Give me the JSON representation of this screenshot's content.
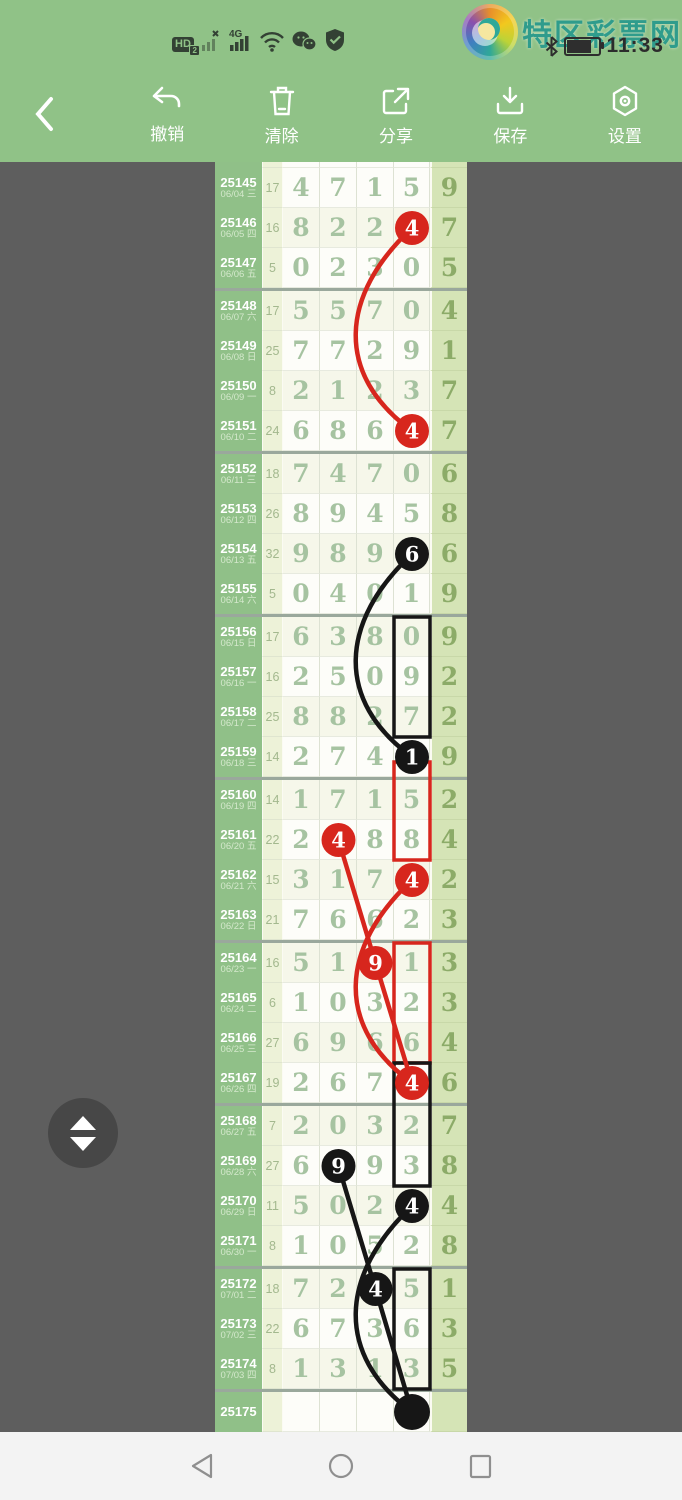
{
  "status_bar": {
    "time": "11:33",
    "hd_label": "HD",
    "hd_badge": "2",
    "network_label": "4G",
    "left_icons": [
      "hd-icon",
      "no-sim-signal-icon",
      "4g-signal-icon",
      "wifi-icon",
      "wechat-icon",
      "security-shield-icon"
    ],
    "right_icons": [
      "bluetooth-icon",
      "battery-icon"
    ]
  },
  "brand": {
    "logo_text": "特区彩票网"
  },
  "toolbar": {
    "items": [
      {
        "label": "撤销",
        "icon": "undo-icon"
      },
      {
        "label": "清除",
        "icon": "trash-icon"
      },
      {
        "label": "分享",
        "icon": "share-icon"
      },
      {
        "label": "保存",
        "icon": "save-icon"
      },
      {
        "label": "设置",
        "icon": "settings-icon"
      }
    ]
  },
  "colors": {
    "header_green": "#90c287",
    "period_col_green": "#90c088",
    "tail_col_green": "#d5e4b6",
    "mark_red": "#d7261d",
    "mark_black": "#161616"
  },
  "chart": {
    "type": "table",
    "group_separators_after": [
      "25147",
      "25151",
      "25155",
      "25159",
      "25163",
      "25167",
      "25171",
      "25174"
    ],
    "rows": [
      {
        "period": "25145",
        "date": "06/04 三",
        "count": "17",
        "digits": [
          "4",
          "7",
          "1",
          "5"
        ],
        "tail": "9"
      },
      {
        "period": "25146",
        "date": "06/05 四",
        "count": "16",
        "digits": [
          "8",
          "2",
          "2",
          "4"
        ],
        "tail": "7"
      },
      {
        "period": "25147",
        "date": "06/06 五",
        "count": "5",
        "digits": [
          "0",
          "2",
          "3",
          "0"
        ],
        "tail": "5"
      },
      {
        "period": "25148",
        "date": "06/07 六",
        "count": "17",
        "digits": [
          "5",
          "5",
          "7",
          "0"
        ],
        "tail": "4"
      },
      {
        "period": "25149",
        "date": "06/08 日",
        "count": "25",
        "digits": [
          "7",
          "7",
          "2",
          "9"
        ],
        "tail": "1"
      },
      {
        "period": "25150",
        "date": "06/09 一",
        "count": "8",
        "digits": [
          "2",
          "1",
          "2",
          "3"
        ],
        "tail": "7"
      },
      {
        "period": "25151",
        "date": "06/10 二",
        "count": "24",
        "digits": [
          "6",
          "8",
          "6",
          "4"
        ],
        "tail": "7"
      },
      {
        "period": "25152",
        "date": "06/11 三",
        "count": "18",
        "digits": [
          "7",
          "4",
          "7",
          "0"
        ],
        "tail": "6"
      },
      {
        "period": "25153",
        "date": "06/12 四",
        "count": "26",
        "digits": [
          "8",
          "9",
          "4",
          "5"
        ],
        "tail": "8"
      },
      {
        "period": "25154",
        "date": "06/13 五",
        "count": "32",
        "digits": [
          "9",
          "8",
          "9",
          "6"
        ],
        "tail": "6"
      },
      {
        "period": "25155",
        "date": "06/14 六",
        "count": "5",
        "digits": [
          "0",
          "4",
          "0",
          "1"
        ],
        "tail": "9"
      },
      {
        "period": "25156",
        "date": "06/15 日",
        "count": "17",
        "digits": [
          "6",
          "3",
          "8",
          "0"
        ],
        "tail": "9"
      },
      {
        "period": "25157",
        "date": "06/16 一",
        "count": "16",
        "digits": [
          "2",
          "5",
          "0",
          "9"
        ],
        "tail": "2"
      },
      {
        "period": "25158",
        "date": "06/17 二",
        "count": "25",
        "digits": [
          "8",
          "8",
          "2",
          "7"
        ],
        "tail": "2"
      },
      {
        "period": "25159",
        "date": "06/18 三",
        "count": "14",
        "digits": [
          "2",
          "7",
          "4",
          "1"
        ],
        "tail": "9"
      },
      {
        "period": "25160",
        "date": "06/19 四",
        "count": "14",
        "digits": [
          "1",
          "7",
          "1",
          "5"
        ],
        "tail": "2"
      },
      {
        "period": "25161",
        "date": "06/20 五",
        "count": "22",
        "digits": [
          "2",
          "4",
          "8",
          "8"
        ],
        "tail": "4"
      },
      {
        "period": "25162",
        "date": "06/21 六",
        "count": "15",
        "digits": [
          "3",
          "1",
          "7",
          "4"
        ],
        "tail": "2"
      },
      {
        "period": "25163",
        "date": "06/22 日",
        "count": "21",
        "digits": [
          "7",
          "6",
          "6",
          "2"
        ],
        "tail": "3"
      },
      {
        "period": "25164",
        "date": "06/23 一",
        "count": "16",
        "digits": [
          "5",
          "1",
          "9",
          "1"
        ],
        "tail": "3"
      },
      {
        "period": "25165",
        "date": "06/24 二",
        "count": "6",
        "digits": [
          "1",
          "0",
          "3",
          "2"
        ],
        "tail": "3"
      },
      {
        "period": "25166",
        "date": "06/25 三",
        "count": "27",
        "digits": [
          "6",
          "9",
          "6",
          "6"
        ],
        "tail": "4"
      },
      {
        "period": "25167",
        "date": "06/26 四",
        "count": "19",
        "digits": [
          "2",
          "6",
          "7",
          "4"
        ],
        "tail": "6"
      },
      {
        "period": "25168",
        "date": "06/27 五",
        "count": "7",
        "digits": [
          "2",
          "0",
          "3",
          "2"
        ],
        "tail": "7"
      },
      {
        "period": "25169",
        "date": "06/28 六",
        "count": "27",
        "digits": [
          "6",
          "9",
          "9",
          "3"
        ],
        "tail": "8"
      },
      {
        "period": "25170",
        "date": "06/29 日",
        "count": "11",
        "digits": [
          "5",
          "0",
          "2",
          "4"
        ],
        "tail": "4"
      },
      {
        "period": "25171",
        "date": "06/30 一",
        "count": "8",
        "digits": [
          "1",
          "0",
          "5",
          "2"
        ],
        "tail": "8"
      },
      {
        "period": "25172",
        "date": "07/01 二",
        "count": "18",
        "digits": [
          "7",
          "2",
          "4",
          "5"
        ],
        "tail": "1"
      },
      {
        "period": "25173",
        "date": "07/02 三",
        "count": "22",
        "digits": [
          "6",
          "7",
          "3",
          "6"
        ],
        "tail": "3"
      },
      {
        "period": "25174",
        "date": "07/03 四",
        "count": "8",
        "digits": [
          "1",
          "3",
          "1",
          "3"
        ],
        "tail": "5"
      },
      {
        "period": "25175",
        "date": "",
        "count": "",
        "digits": [
          "",
          "",
          "",
          ""
        ],
        "tail": ""
      }
    ],
    "marks": {
      "circles": [
        {
          "row": "25146",
          "col": 4,
          "value": "4",
          "color": "red"
        },
        {
          "row": "25151",
          "col": 4,
          "value": "4",
          "color": "red"
        },
        {
          "row": "25154",
          "col": 4,
          "value": "6",
          "color": "black"
        },
        {
          "row": "25159",
          "col": 4,
          "value": "1",
          "color": "black"
        },
        {
          "row": "25161",
          "col": 2,
          "value": "4",
          "color": "red"
        },
        {
          "row": "25162",
          "col": 4,
          "value": "4",
          "color": "red"
        },
        {
          "row": "25164",
          "col": 3,
          "value": "9",
          "color": "red"
        },
        {
          "row": "25167",
          "col": 4,
          "value": "4",
          "color": "red"
        },
        {
          "row": "25169",
          "col": 2,
          "value": "9",
          "color": "black"
        },
        {
          "row": "25170",
          "col": 4,
          "value": "4",
          "color": "black"
        },
        {
          "row": "25172",
          "col": 3,
          "value": "4",
          "color": "black"
        },
        {
          "row": "25175",
          "col": 4,
          "value": "",
          "color": "black",
          "filled_dot": true
        }
      ],
      "boxes": [
        {
          "from": "25156",
          "to": "25158",
          "col": 4,
          "color": "black"
        },
        {
          "from": "25160",
          "to": "25161",
          "col": 4,
          "color": "red",
          "extend_top": true
        },
        {
          "from": "25164",
          "to": "25166",
          "col": 4,
          "color": "red"
        },
        {
          "from": "25167",
          "to": "25169",
          "col": 4,
          "color": "black"
        },
        {
          "from": "25172",
          "to": "25174",
          "col": 4,
          "color": "black"
        }
      ],
      "lines": [
        {
          "from": "25146",
          "fcol": 4,
          "to": "25151",
          "tcol": 4,
          "color": "red",
          "curve": "left"
        },
        {
          "from": "25154",
          "fcol": 4,
          "to": "25159",
          "tcol": 4,
          "color": "black",
          "curve": "left"
        },
        {
          "from": "25161",
          "fcol": 2,
          "to": "25164",
          "tcol": 3,
          "color": "red",
          "curve": "none"
        },
        {
          "from": "25164",
          "fcol": 3,
          "to": "25167",
          "tcol": 4,
          "color": "red",
          "curve": "none"
        },
        {
          "from": "25162",
          "fcol": 4,
          "to": "25167",
          "tcol": 4,
          "color": "red",
          "curve": "left"
        },
        {
          "from": "25169",
          "fcol": 2,
          "to": "25172",
          "tcol": 3,
          "color": "black",
          "curve": "none"
        },
        {
          "from": "25172",
          "fcol": 3,
          "to": "25175",
          "tcol": 4,
          "color": "black",
          "curve": "none"
        },
        {
          "from": "25170",
          "fcol": 4,
          "to": "25175",
          "tcol": 4,
          "color": "black",
          "curve": "left"
        }
      ]
    }
  },
  "nav_bar": {
    "icons": [
      "back-triangle-icon",
      "home-circle-icon",
      "recents-square-icon"
    ]
  }
}
